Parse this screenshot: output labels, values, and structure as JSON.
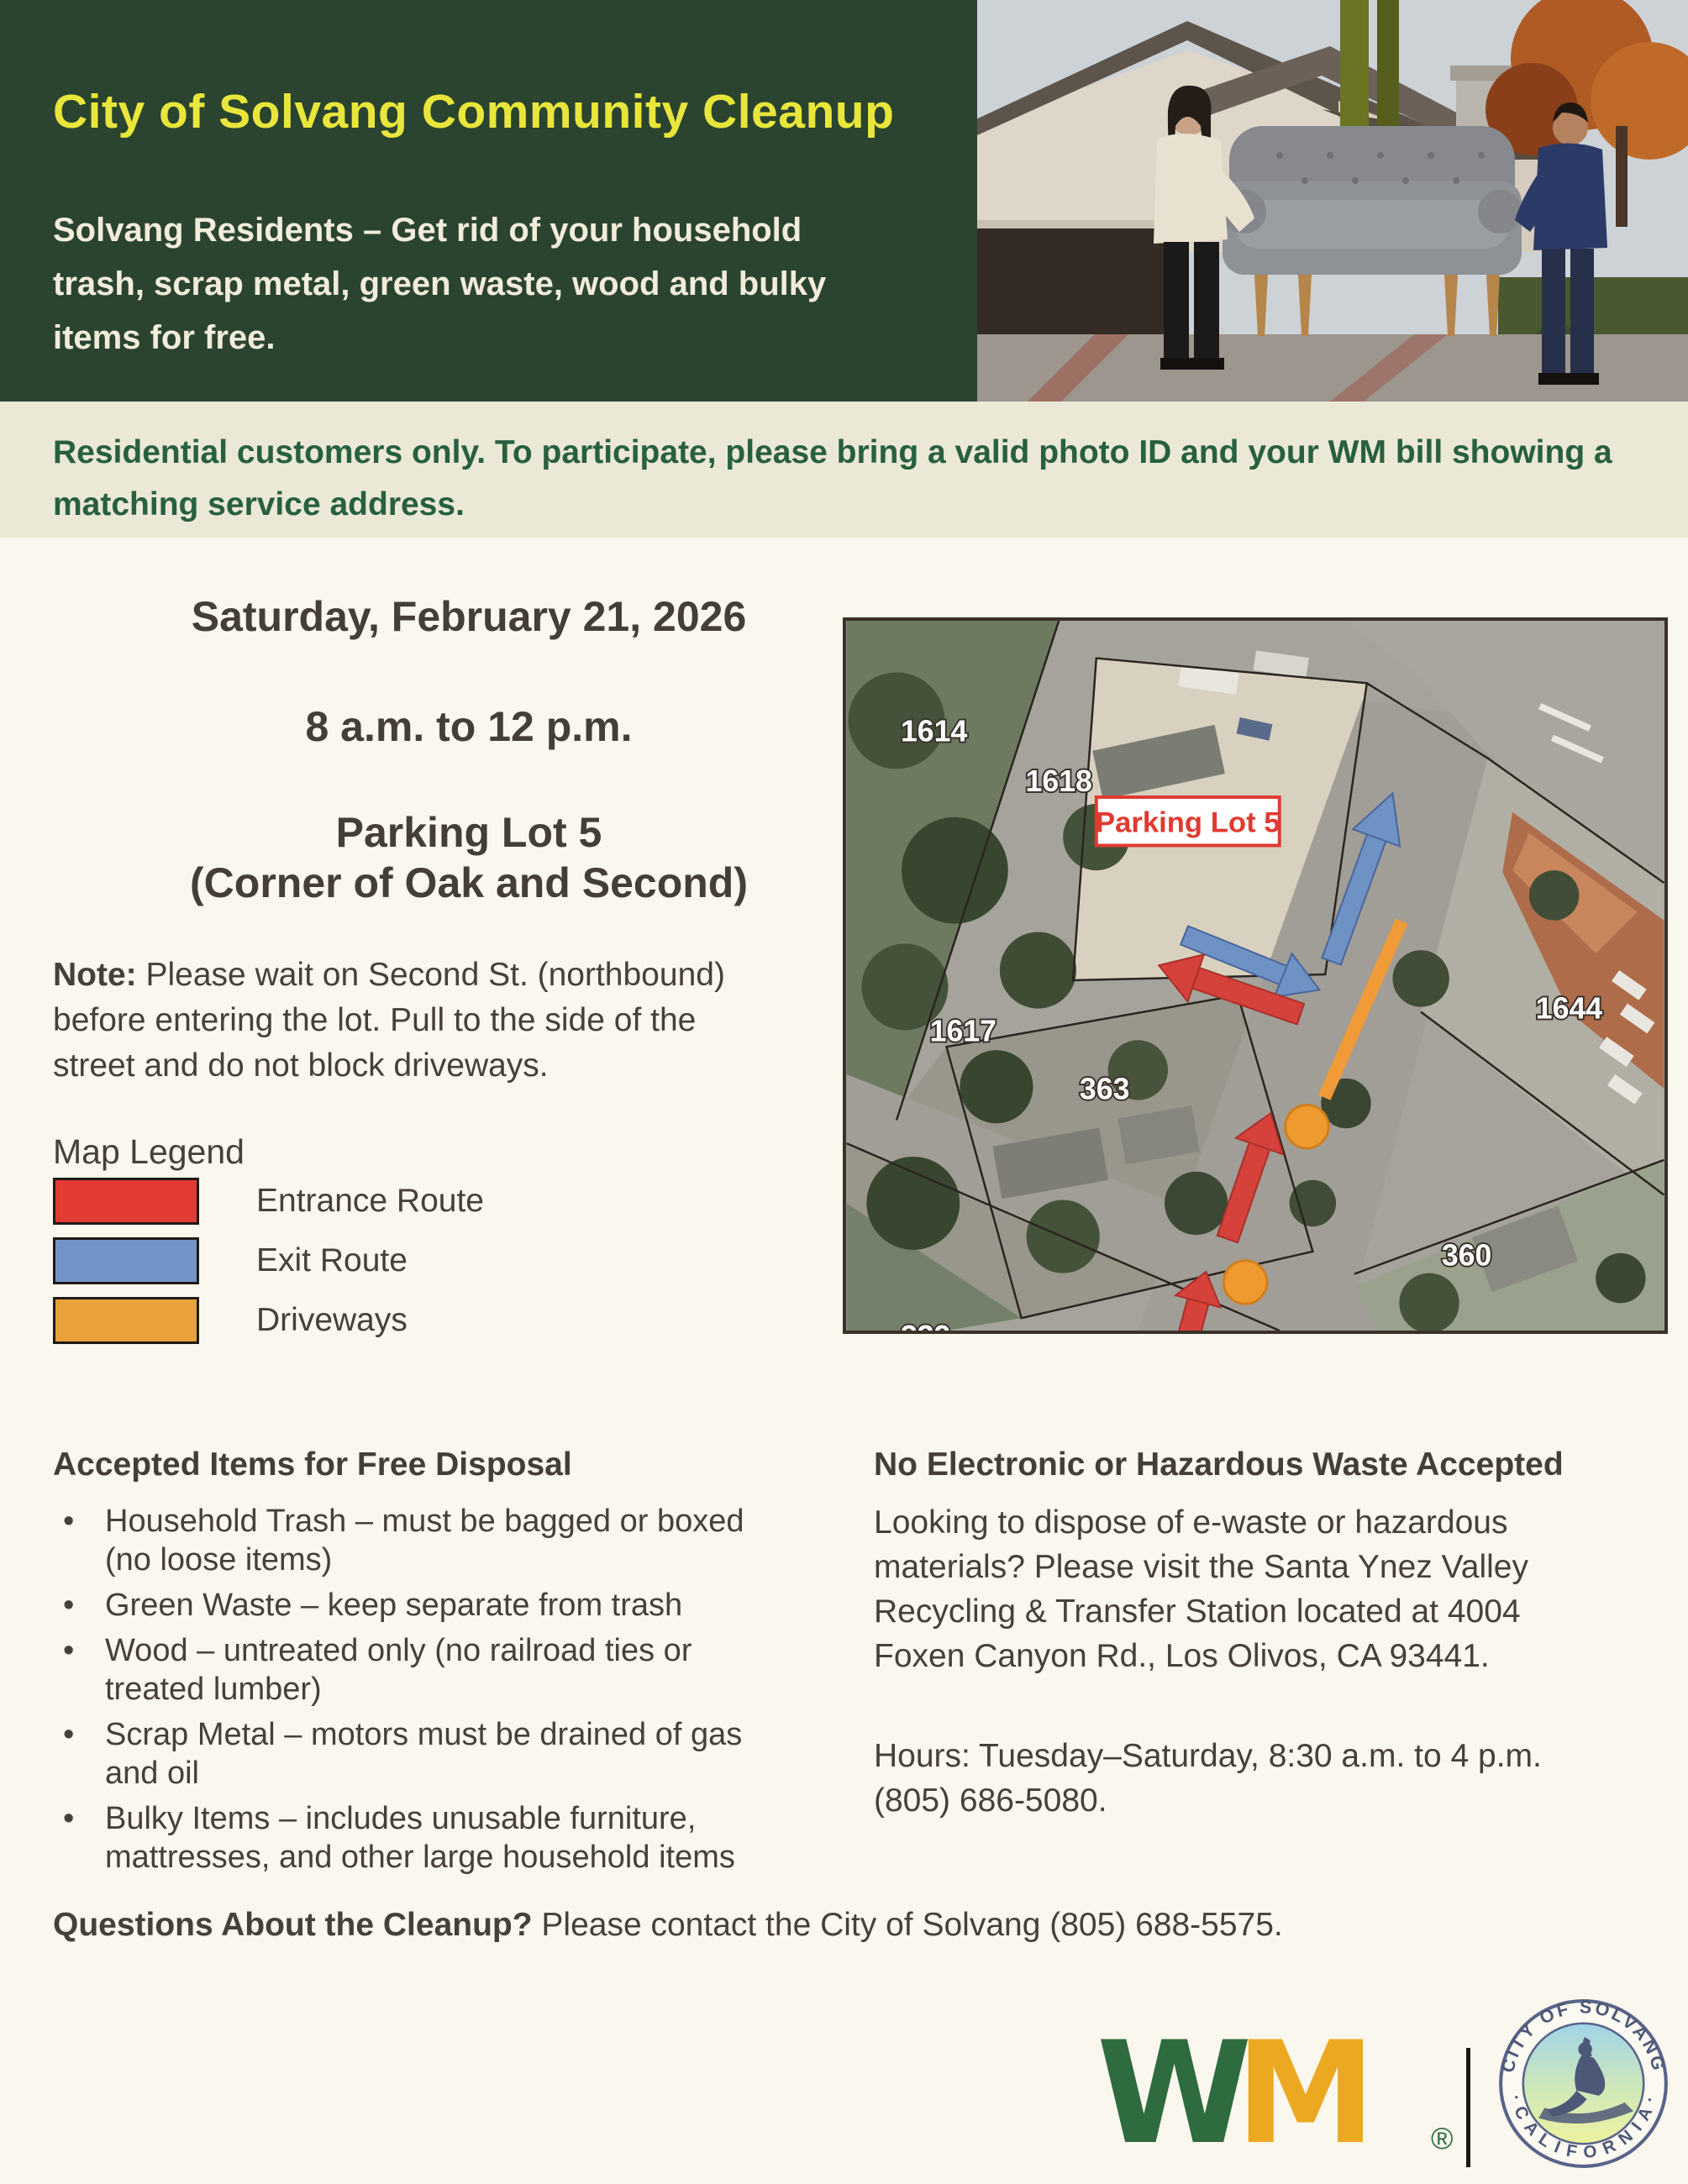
{
  "header": {
    "title": "City of Solvang Community Cleanup",
    "subtitle": "Solvang Residents – Get rid of your household\ntrash, scrap metal, green waste, wood and bulky\nitems for free.",
    "bg_color": "#2a4430",
    "title_color": "#e9e63b"
  },
  "notice": {
    "text": "Residential customers only. To participate, please bring a valid photo ID and your WM bill showing a\nmatching service address.",
    "text_color": "#27603f",
    "bg_color": "#ebe8d5"
  },
  "event": {
    "date": "Saturday, February 21, 2026",
    "time": "8 a.m. to 12 p.m.",
    "location_line1": "Parking Lot 5",
    "location_line2": "(Corner of Oak and Second)",
    "note_label": "Note:",
    "note_text": "Please wait on Second St. (northbound)\nbefore entering the lot. Pull to the side of the\nstreet and do not block driveways."
  },
  "legend": {
    "title": "Map Legend",
    "items": [
      {
        "label": "Entrance Route",
        "color": "#e23b33"
      },
      {
        "label": "Exit Route",
        "color": "#7294c7"
      },
      {
        "label": "Driveways",
        "color": "#e9a13b"
      }
    ]
  },
  "map": {
    "parking_label": "Parking Lot 5",
    "parcel_labels": {
      "p1614": "1614",
      "p1618": "1618",
      "p1617": "1617",
      "p363": "363",
      "p1644": "1644",
      "p360": "360",
      "p339": "339"
    }
  },
  "accepted": {
    "title": "Accepted Items for Free Disposal",
    "items": [
      "Household Trash – must be bagged or boxed\n(no loose items)",
      "Green Waste – keep separate from trash",
      "Wood – untreated only (no railroad ties or\ntreated lumber)",
      "Scrap Metal – motors must be drained of gas\nand oil",
      "Bulky Items – includes unusable furniture,\nmattresses, and other large household items"
    ]
  },
  "hazardous": {
    "title": "No Electronic or Hazardous Waste Accepted",
    "body": "Looking to dispose of e-waste or hazardous\nmaterials? Please visit the Santa Ynez Valley\nRecycling & Transfer Station located at 4004\nFoxen Canyon Rd., Los Olivos, CA 93441.",
    "hours": "Hours: Tuesday–Saturday, 8:30 a.m. to 4 p.m.\n(805) 686-5080."
  },
  "questions": {
    "label": "Questions About the Cleanup?",
    "text": "Please contact the City of Solvang (805) 688-5575."
  },
  "footer": {
    "wm_w": "W",
    "wm_m": "M",
    "wm_reg": "®",
    "wm_green": "#2e6b3e",
    "wm_gold": "#eca821",
    "seal_arc_top": "CITY OF SOLVANG",
    "seal_arc_bottom": "· C A L I F O R N I A ·"
  }
}
